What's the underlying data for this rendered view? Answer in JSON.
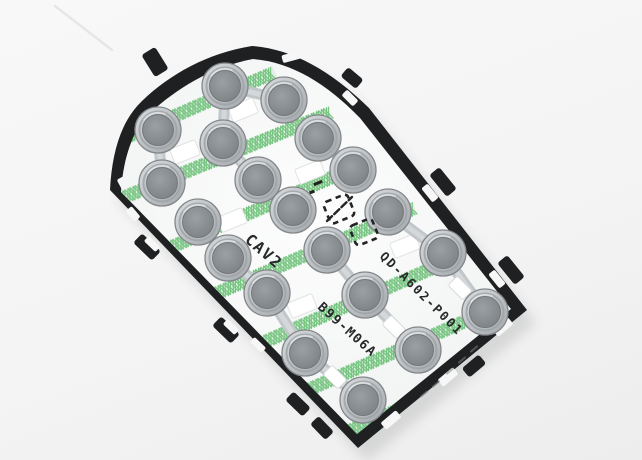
{
  "photo": {
    "background_top": "#f8f8f8",
    "background_bottom": "#ededed",
    "shadow_color": "#2a2e33"
  },
  "part": {
    "labels": {
      "cavity": "CAV2",
      "part_number": "QD-A602-P001",
      "tool_number": "B99-M06A"
    },
    "colors": {
      "frame": "#1e2022",
      "frame_edge_mark": "#7a7d80",
      "membrane_center": "#fdfdfd",
      "membrane_edge": "#eef0f0",
      "trace_green": "#74c47e",
      "trace_green_soft": "rgba(132,201,142,0.16)",
      "dome_outer_light": "#d8dbde",
      "dome_outer_dark": "#a2a7ab",
      "dome_outline": "#84878a",
      "dome_ring": "#9ea3a6",
      "dome_inner_center": "#9aa0a4",
      "dome_inner_edge": "#7b7f82",
      "dome_inner_outline": "#74787b",
      "link": "#c2c7ca",
      "link_highlight": "#d6dadc",
      "cutout_fill": "#ffffff",
      "cutout_edge": "#e1e3e3",
      "marking": "#232323",
      "label_ink": "#26282a",
      "scratch": "#e4e4e4"
    },
    "outline_outer": "M 110 190 C 112 152 121 121 142 101 C 170 74 208 53 252 46 C 292 49 330 70 369 108 L 527 310 L 358 448 Z",
    "outline_inner": "M 121 192 C 123 161 131 132 150 113 C 176 89 211 67 253 59 C 291 62 326 83 360 118 L 511 309 L 357 434 Z",
    "domes": [
      [
        225,
        86
      ],
      [
        284,
        100
      ],
      [
        158,
        130
      ],
      [
        223,
        143
      ],
      [
        318,
        138
      ],
      [
        353,
        170
      ],
      [
        162,
        183
      ],
      [
        258,
        180
      ],
      [
        293,
        210
      ],
      [
        388,
        212
      ],
      [
        198,
        222
      ],
      [
        228,
        258
      ],
      [
        327,
        250
      ],
      [
        443,
        253
      ],
      [
        267,
        293
      ],
      [
        365,
        295
      ],
      [
        418,
        350
      ],
      [
        305,
        353
      ],
      [
        485,
        312
      ],
      [
        363,
        400
      ]
    ],
    "links": [
      [
        0,
        1
      ],
      [
        0,
        3
      ],
      [
        2,
        6
      ],
      [
        3,
        7
      ],
      [
        4,
        5
      ],
      [
        7,
        8
      ],
      [
        9,
        13
      ],
      [
        10,
        11
      ],
      [
        11,
        14
      ],
      [
        12,
        15
      ],
      [
        14,
        17
      ],
      [
        13,
        18
      ],
      [
        15,
        16
      ],
      [
        17,
        19
      ]
    ],
    "strips": [
      [
        120,
        140,
        275,
        72
      ],
      [
        105,
        205,
        330,
        113
      ],
      [
        123,
        268,
        372,
        160
      ],
      [
        150,
        322,
        415,
        208
      ],
      [
        196,
        372,
        460,
        256
      ],
      [
        248,
        416,
        500,
        306
      ],
      [
        305,
        450,
        495,
        368
      ]
    ],
    "cutouts": [
      [
        243,
        110,
        -22
      ],
      [
        185,
        152,
        -22
      ],
      [
        310,
        172,
        -22
      ],
      [
        232,
        220,
        -22
      ],
      [
        405,
        246,
        -22
      ],
      [
        302,
        306,
        -22
      ]
    ],
    "pads": [
      [
        460,
        288,
        45
      ],
      [
        394,
        327,
        45
      ],
      [
        335,
        377,
        45
      ]
    ],
    "tabs": [
      [
        155,
        62,
        16,
        26,
        -32
      ],
      [
        352,
        78,
        20,
        12,
        40
      ],
      [
        443,
        182,
        28,
        13,
        51
      ],
      [
        511,
        270,
        28,
        13,
        51
      ],
      [
        474,
        366,
        22,
        12,
        -40
      ],
      [
        322,
        428,
        22,
        12,
        46
      ],
      [
        147,
        247,
        26,
        13,
        44
      ],
      [
        226,
        330,
        26,
        13,
        44
      ],
      [
        298,
        404,
        24,
        12,
        44
      ]
    ],
    "slots": [
      [
        291,
        57,
        18,
        8,
        -15
      ],
      [
        350,
        98,
        16,
        8,
        45
      ],
      [
        430,
        193,
        18,
        8,
        51
      ],
      [
        497,
        279,
        18,
        8,
        51
      ],
      [
        503,
        327,
        20,
        9,
        -40
      ],
      [
        448,
        377,
        20,
        9,
        -40
      ],
      [
        391,
        420,
        20,
        9,
        -40
      ],
      [
        124,
        185,
        16,
        8,
        62
      ],
      [
        133,
        214,
        14,
        8,
        50
      ],
      [
        152,
        244,
        16,
        7,
        44
      ],
      [
        231,
        327,
        16,
        7,
        44
      ],
      [
        258,
        345,
        16,
        7,
        44
      ]
    ],
    "engravings": [
      [
        450,
        371,
        -40
      ],
      [
        462,
        360,
        -40
      ],
      [
        474,
        349,
        -40
      ],
      [
        424,
        394,
        -40
      ],
      [
        436,
        384,
        -40
      ]
    ],
    "marking": {
      "bars": [
        [
          318,
          183,
          9,
          3,
          -22
        ],
        [
          312,
          192,
          5,
          3,
          -22
        ]
      ],
      "boxes": [
        {
          "cx": 339,
          "cy": 209,
          "w": 26,
          "h": 23,
          "rot": -22
        },
        {
          "cx": 364,
          "cy": 232,
          "w": 24,
          "h": 21,
          "rot": -22
        }
      ],
      "slash": [
        327,
        221,
        352,
        197
      ]
    },
    "scratch_line": [
      55,
      6,
      112,
      50
    ]
  }
}
